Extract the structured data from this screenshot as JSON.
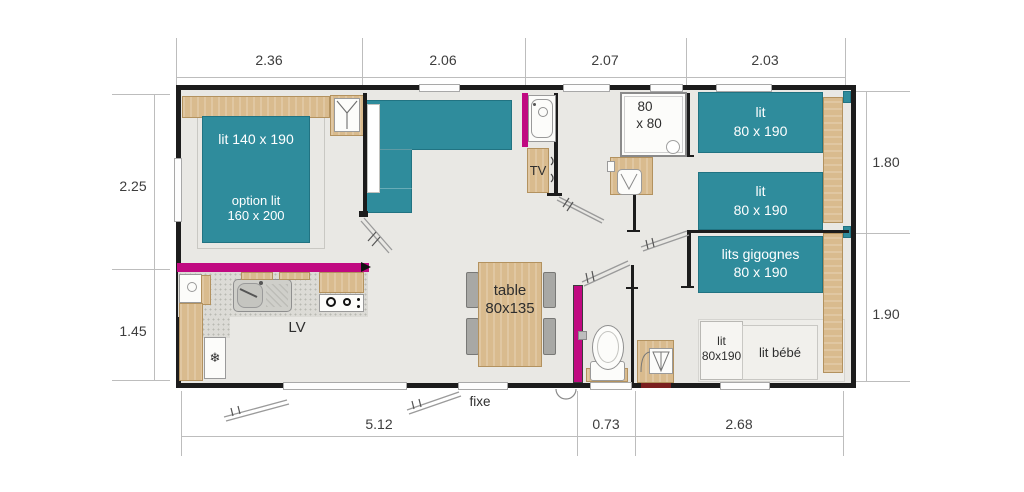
{
  "plan": {
    "dims_top": [
      "2.36",
      "2.06",
      "2.07",
      "2.03"
    ],
    "dims_bottom": [
      "5.12",
      "0.73",
      "2.68"
    ],
    "dims_left": [
      "2.25",
      "1.45"
    ],
    "dims_right": [
      "1.80",
      "1.90"
    ]
  },
  "labels": {
    "master_bed": "lit 140 x 190",
    "master_option1": "option lit",
    "master_option2": "160 x 200",
    "twin1_l1": "lit",
    "twin1_l2": "80 x 190",
    "twin2_l1": "lit",
    "twin2_l2": "80 x 190",
    "bunk_l1": "lits gigognes",
    "bunk_l2": "80 x 190",
    "small_bed_l1": "lit",
    "small_bed_l2": "80x190",
    "baby_bed": "lit bébé",
    "table_l1": "table",
    "table_l2": "80x135",
    "dishwasher": "LV",
    "tv": "TV",
    "shower_l1": "80",
    "shower_l2": "x 80",
    "fixed_bay": "fixe",
    "fridge_icon": "❄"
  },
  "colors": {
    "bed_teal": "#2f8c9c",
    "accent_magenta": "#c00981",
    "wood": "#d9bb8e",
    "wall": "#1c1c1c",
    "floor": "#e9e8e4"
  }
}
